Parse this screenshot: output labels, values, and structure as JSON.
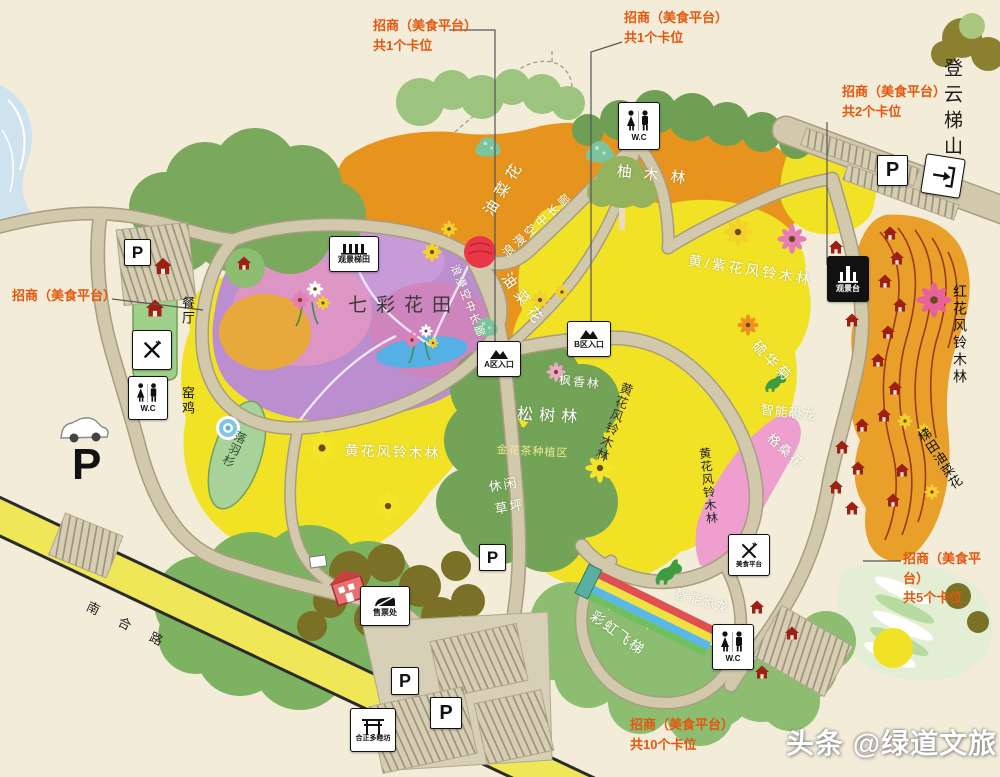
{
  "colors": {
    "background": "#f3ecd9",
    "annotation_red": "#e4570e",
    "field_orange": "#e6941d",
    "field_yellow": "#f2e226",
    "flower_field_purple": "#bb8ecf",
    "canopy_green": "#7aa85c",
    "road_tan": "#d2c9ad",
    "highway_yellow": "#f0e758",
    "pink_band": "#ee9fce",
    "pond_blue": "#55b0e6",
    "hut_red": "#9e2012"
  },
  "annotations": {
    "top_left": {
      "line1": "招商（美食平台）",
      "line2": "共1个卡位"
    },
    "top_center": {
      "line1": "招商（美食平台）",
      "line2": "共1个卡位"
    },
    "top_right": {
      "line1": "招商（美食平台）",
      "line2": "共2个卡位"
    },
    "left": {
      "line1": "招商（美食平台）"
    },
    "right": {
      "line1": "招商（美食平台）",
      "line2": "共5个卡位"
    },
    "bottom": {
      "line1": "招商（美食平台）",
      "line2": "共10个卡位"
    }
  },
  "labels": {
    "dengyun_tishan": "登云梯山",
    "qicai_huatian": "七彩花田",
    "youcaihua": "油菜花",
    "langman_changlang": "浪漫空中长廊",
    "youmulin": "柚木林",
    "huangzihua_fengling": "黄/紫花风铃木林",
    "liuhuaju": "硫华菊",
    "gesanghua": "格桑花",
    "zhineng_konglong": "智能恐龙",
    "honghua_fengling": "红花风铃木林",
    "titian_youcaihua": "梯田油菜花",
    "huanghua_fengling": "黄花风铃木林",
    "songshulin": "松树林",
    "fengxianglin": "枫香林",
    "jinhuacha": "金花茶种植区",
    "xiuxian": "休闲",
    "caoping": "草坪",
    "yaoji": "窑鸡",
    "canting": "餐厅",
    "luoyushan": "落羽杉",
    "caihong_feiti": "彩虹飞梯",
    "nanhelu": "南合路"
  },
  "signs": {
    "wc": "W.C",
    "parking": "P",
    "guanjing_titian": "观景梯田",
    "a_entrance": "A区入口",
    "b_entrance": "B区入口",
    "guanjingtai": "观景台",
    "shoupiaochu": "售票处",
    "meishi_pingtai": "美食平台",
    "gate": "合正多睦坊"
  },
  "watermark": "头条 @绿道文旅"
}
